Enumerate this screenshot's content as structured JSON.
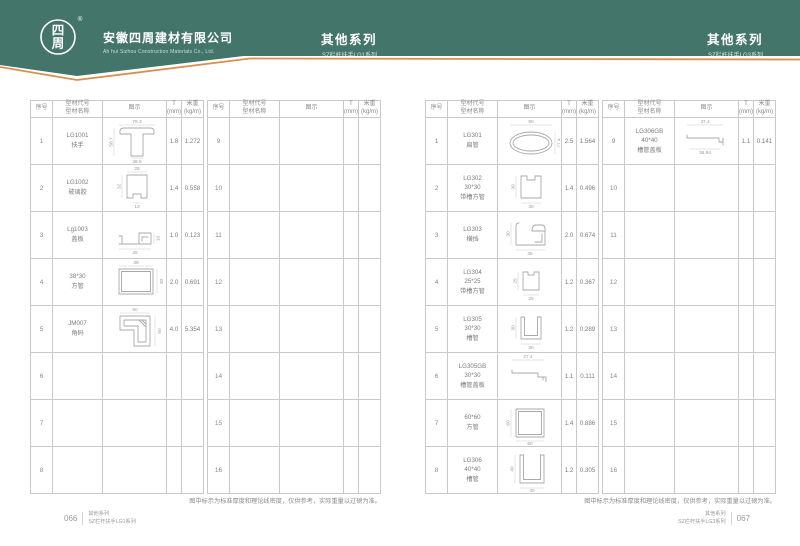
{
  "colors": {
    "teal": "#44756a",
    "orange": "#d98f4e"
  },
  "header": {
    "logo_char1": "四",
    "logo_char2": "周",
    "registered_mark": "®",
    "company_cn": "安徽四周建材有限公司",
    "company_en": "Ah hui Sizhou Construction Materials Co., Ltd.",
    "series_center": {
      "title": "其他系列",
      "subtitle": "SZ栏杆扶手LG1系列"
    },
    "series_right": {
      "title": "其他系列",
      "subtitle": "SZ栏杆扶手LG3系列"
    }
  },
  "table_header": {
    "no": "序号",
    "code": "型材代号",
    "name": "型材名称",
    "diagram": "图示",
    "t1": "T",
    "t2": "(mm)",
    "w1": "米重",
    "w2": "(kg/m)"
  },
  "note": "图中标示为标准厚度和理论线密度，仅供参考，实际重量以过磅为准。",
  "footers": {
    "left": {
      "page": "066",
      "series": "其他系列",
      "subtitle": "SZ栏杆扶手LG1系列"
    },
    "right": {
      "page": "067",
      "series": "其他系列",
      "subtitle": "SZ栏杆扶手LG3系列"
    }
  },
  "tables": {
    "p1a": [
      {
        "no": "1",
        "code": "LG1001",
        "name": "扶手",
        "t": "1.8",
        "w": "1.272",
        "d1": "78.3",
        "d2": "58.7",
        "d3": "38.5"
      },
      {
        "no": "2",
        "code": "LG1002",
        "name": "玻璃胶",
        "t": "1.4",
        "w": "0.558",
        "d1": "25",
        "d2": "32",
        "d3": "13"
      },
      {
        "no": "3",
        "code": "Lg1003",
        "name": "盖板",
        "t": "1.0",
        "w": "0.123",
        "d1": "25",
        "d2": "10"
      },
      {
        "no": "4",
        "code": "38*30",
        "name": "方管",
        "t": "2.0",
        "w": "0.691",
        "d1": "38",
        "d2": "30"
      },
      {
        "no": "5",
        "code": "JM007",
        "name": "角码",
        "t": "4.0",
        "w": "5.354",
        "d1": "50",
        "d2": "50"
      },
      {
        "no": "6"
      },
      {
        "no": "7"
      },
      {
        "no": "8"
      }
    ],
    "p1b": [
      {
        "no": "9"
      },
      {
        "no": "10"
      },
      {
        "no": "11"
      },
      {
        "no": "12"
      },
      {
        "no": "13"
      },
      {
        "no": "14"
      },
      {
        "no": "15"
      },
      {
        "no": "16"
      }
    ],
    "p2a": [
      {
        "no": "1",
        "code": "LG301",
        "name": "扁管",
        "t": "2.5",
        "w": "1.564",
        "d1": "90",
        "d2": "27.4"
      },
      {
        "no": "2",
        "code": "LG302",
        "spec": "30*30",
        "name": "带槽方管",
        "t": "1.4",
        "w": "0.496",
        "d1": "30",
        "d2": "30"
      },
      {
        "no": "3",
        "code": "LG303",
        "name": "横挡",
        "t": "2.0",
        "w": "0.674",
        "d1": "30",
        "d2": "35"
      },
      {
        "no": "4",
        "code": "LG304",
        "spec": "25*25",
        "name": "带槽方管",
        "t": "1.2",
        "w": "0.367",
        "d1": "25",
        "d2": "25"
      },
      {
        "no": "5",
        "code": "LG305",
        "spec": "30*30",
        "name": "槽管",
        "t": "1.2",
        "w": "0.289",
        "d1": "30",
        "d2": "30"
      },
      {
        "no": "6",
        "code": "LG305GB",
        "spec": "30*30",
        "name": "槽管盖板",
        "t": "1.1",
        "w": "0.111",
        "d1": "27.4"
      },
      {
        "no": "7",
        "code": "60*60",
        "name": "方管",
        "t": "1.4",
        "w": "0.886",
        "d1": "60",
        "d2": "60"
      },
      {
        "no": "8",
        "code": "LG306",
        "spec": "40*40",
        "name": "槽管",
        "t": "1.2",
        "w": "0.305",
        "d1": "40",
        "d2": "40"
      }
    ],
    "p2b": [
      {
        "no": "9",
        "code": "LG306GB",
        "spec": "40*40",
        "name": "槽管盖板",
        "t": "1.1",
        "w": "0.141",
        "d1": "37.4",
        "d2": "36.94"
      },
      {
        "no": "10"
      },
      {
        "no": "11"
      },
      {
        "no": "12"
      },
      {
        "no": "13"
      },
      {
        "no": "14"
      },
      {
        "no": "15"
      },
      {
        "no": "16"
      }
    ]
  }
}
